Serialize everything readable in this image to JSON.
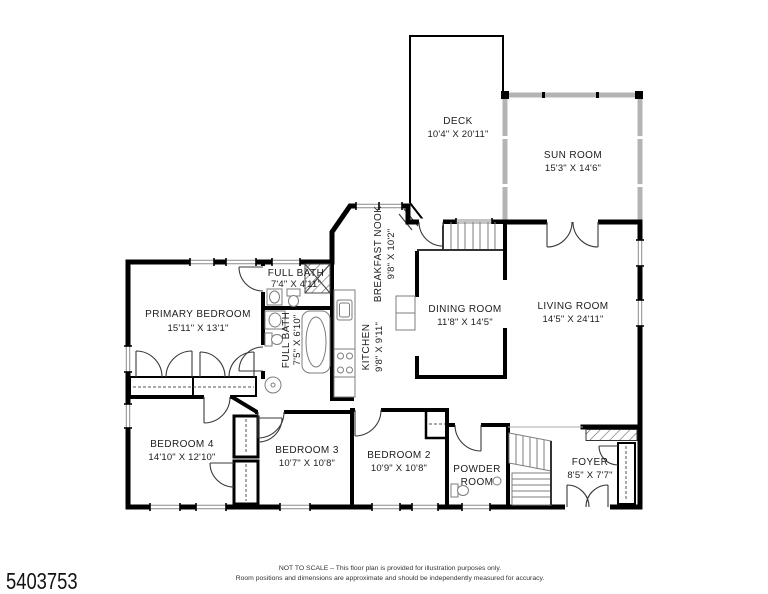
{
  "plan": {
    "rooms": {
      "deck": {
        "name": "DECK",
        "dims": "10'4\" X 20'11\""
      },
      "sun_room": {
        "name": "SUN ROOM",
        "dims": "15'3\" X 14'6\""
      },
      "breakfast_nook": {
        "name": "BREAKFAST NOOK",
        "dims": "9'8\" X 10'2\""
      },
      "kitchen": {
        "name": "KITCHEN",
        "dims": "9'8\" X 9'11\""
      },
      "dining_room": {
        "name": "DINING ROOM",
        "dims": "11'8\" X 14'5\""
      },
      "living_room": {
        "name": "LIVING ROOM",
        "dims": "14'5\" X 24'11\""
      },
      "full_bath_upper": {
        "name": "FULL BATH",
        "dims": "7'4\" X 4'11\""
      },
      "full_bath_lower": {
        "name": "FULL BATH",
        "dims": "7'5\" X 6'10\""
      },
      "primary_bedroom": {
        "name": "PRIMARY BEDROOM",
        "dims": "15'11\" X 13'1\""
      },
      "bedroom_4": {
        "name": "BEDROOM 4",
        "dims": "14'10\" X 12'10\""
      },
      "bedroom_3": {
        "name": "BEDROOM 3",
        "dims": "10'7\" X 10'8\""
      },
      "bedroom_2": {
        "name": "BEDROOM 2",
        "dims": "10'9\" X 10'8\""
      },
      "powder_room": {
        "line1": "POWDER",
        "line2": "ROOM"
      },
      "foyer": {
        "name": "FOYER",
        "dims": "8'5\" X 7'7\""
      }
    },
    "colors": {
      "walls": "#000000",
      "window_walls": "#b4b4b4",
      "fixtures": "#7d7d7d",
      "background": "#ffffff"
    }
  },
  "footer": {
    "listing_number": "5403753",
    "disclaimer_line1": "NOT TO SCALE – This floor plan is provided for illustration purposes only.",
    "disclaimer_line2": "Room positions and dimensions are approximate and should be independently measured for accuracy."
  }
}
